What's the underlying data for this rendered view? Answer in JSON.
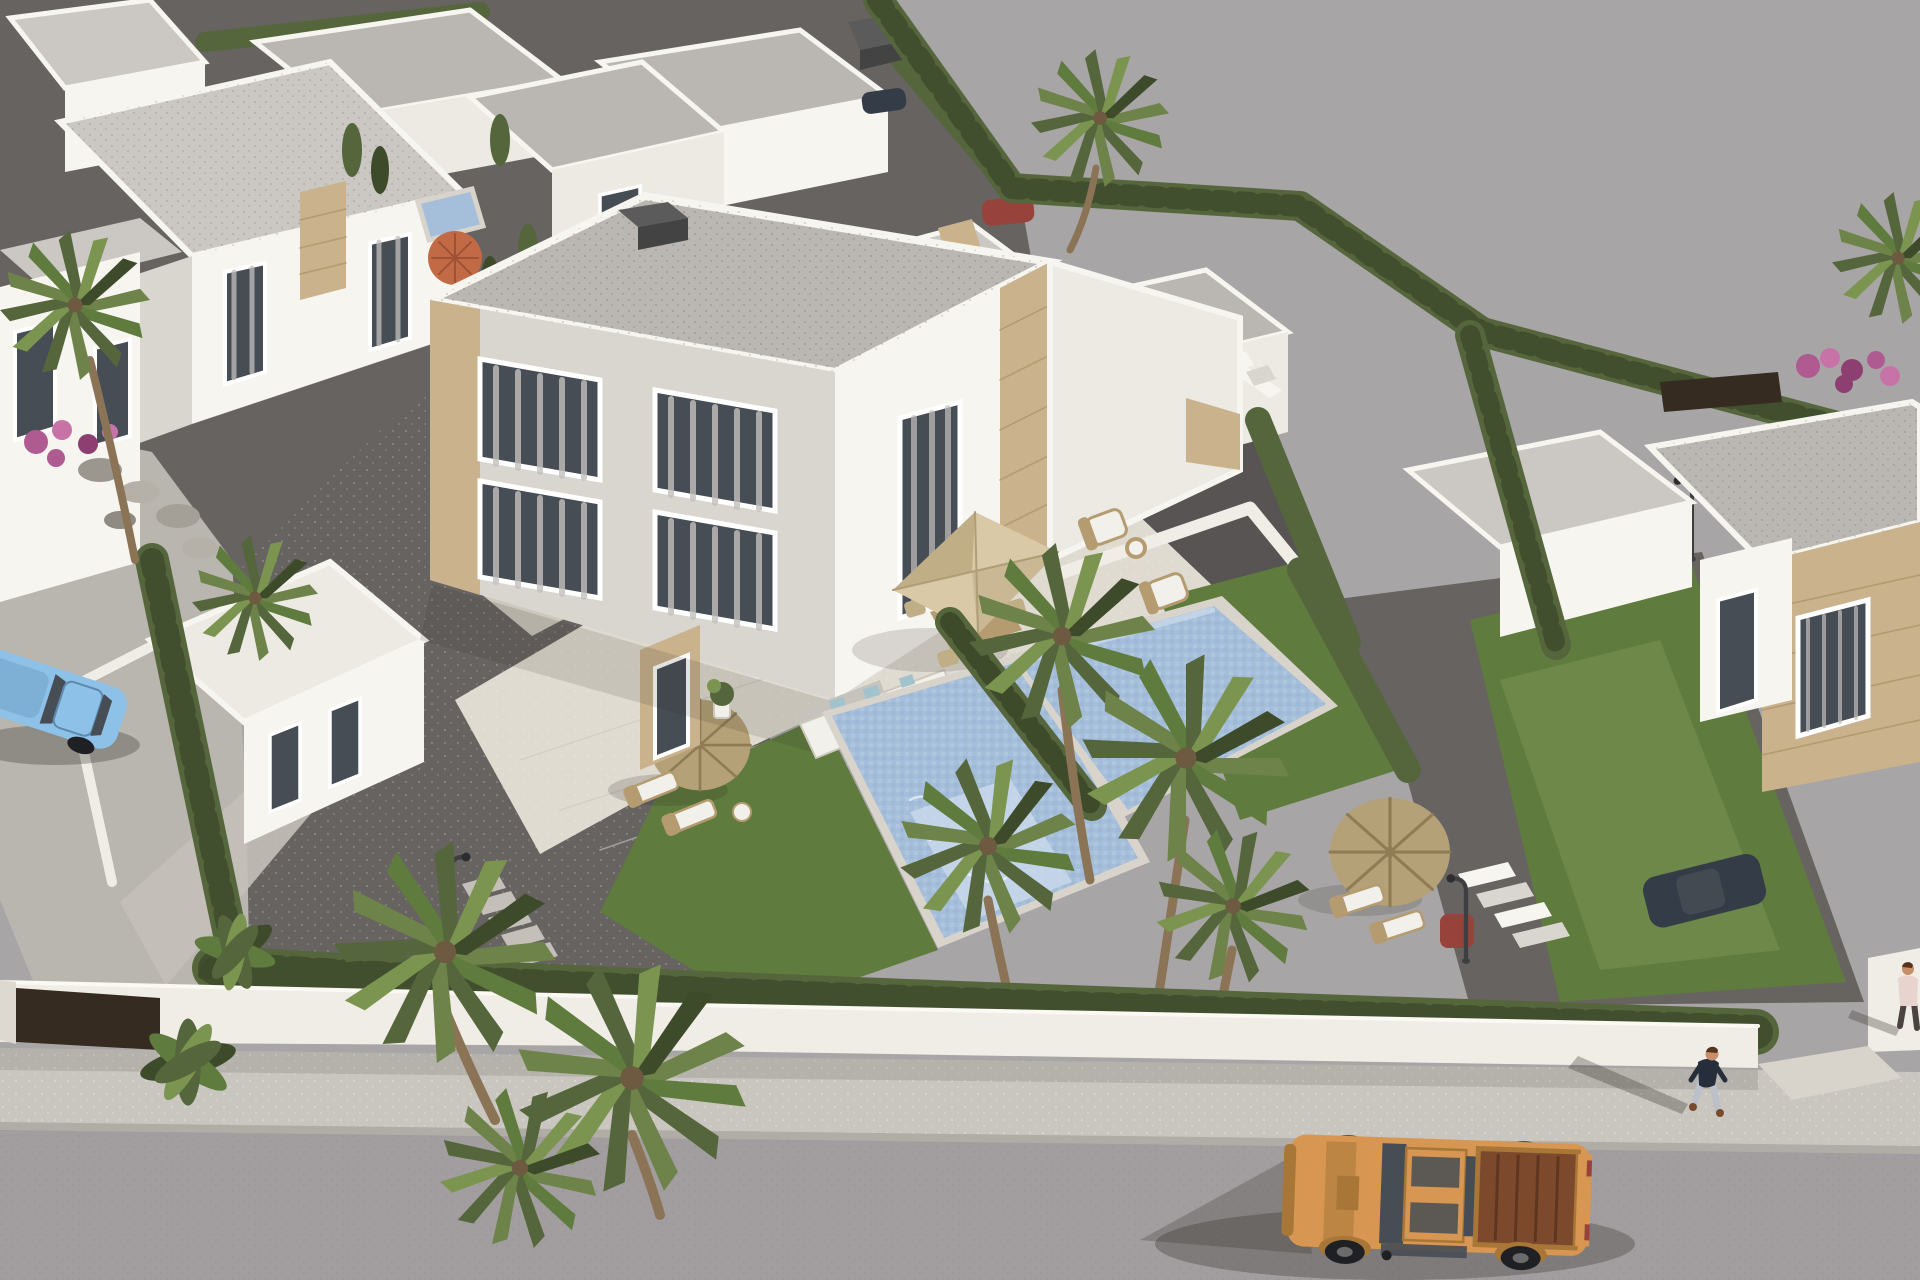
{
  "scene": {
    "label": "Aerial 3D architectural render of a modern white villa development with private pools, gravel gardens, palm trees, a street with a tan pickup truck and pedestrians",
    "objects": [
      "white-villas",
      "duplex-villa",
      "flat-roofs",
      "stone-cladding",
      "curtained-windows",
      "glass-balustrade-terrace",
      "outdoor-corner-sofa",
      "beige-square-parasol",
      "dining-set",
      "wicker-armchairs",
      "sun-loungers",
      "straw-parasols",
      "orange-parasol",
      "left-swimming-pool",
      "right-swimming-pool",
      "lawns",
      "gravel-gardens",
      "cypress-hedges",
      "palm-trees",
      "banana-plants",
      "bougainvillea",
      "rock-bed",
      "perimeter-wall",
      "driveway-gate",
      "stepping-stones",
      "street-lamps",
      "sidewalk",
      "street",
      "pickup-truck",
      "blue-car",
      "red-car",
      "dark-car",
      "walking-pedestrian",
      "partial-pedestrian",
      "empty-ground"
    ]
  },
  "colors": {
    "field": "#a8a5a6",
    "road": "#a29e9f",
    "sidewalk": "#c9c5bf",
    "curb": "#b0aca6",
    "apron": "#d8d4cc",
    "wall": "#f0ede6",
    "wall_shade": "#ddd9d1",
    "gate": "#352b21",
    "hedge_dark": "#3e4b2b",
    "hedge_mid": "#55663c",
    "hedge_light": "#6e8349",
    "lawn": "#5f7b3e",
    "lawn_light": "#7b9551",
    "gravel": "#666361",
    "gravel_dark": "#575453",
    "path": "#c4c0b9",
    "villa": "#f7f5f0",
    "villa_light": "#eceae3",
    "villa_shade": "#d9d6cf",
    "villa_dark": "#c6c3bc",
    "roof": "#bab7b3",
    "roof_light": "#cbc8c4",
    "roof_dark": "#a7a4a0",
    "stone": "#c9b28c",
    "stone_dark": "#ab9568",
    "glass": "#474d55",
    "curtain": "#c3c0bd",
    "pool": "#a5bed9",
    "pool_light": "#c8d8ea",
    "pool_dark": "#8fa9c9",
    "coping": "#d9d4cb",
    "tile": "#e0dbd1",
    "tile_shade": "#cdc7bc",
    "parasol_beige": "#d9c9a7",
    "parasol_beige_dark": "#c0ae87",
    "straw": "#b5a177",
    "straw_dark": "#8f7c55",
    "parasol_orange": "#c16a45",
    "wood": "#b59b70",
    "cushion": "#f2f0ea",
    "pillow_blue": "#a2c2cd",
    "truck": "#d79752",
    "truck_dark": "#a87637",
    "truck_bed": "#7c492c",
    "tire": "#1f2023",
    "car_blue": "#8dc1e7",
    "car_blue_dark": "#5e8aae",
    "car_red": "#97423a",
    "car_navy": "#343c48",
    "skin": "#c78e68",
    "hair": "#54331f",
    "shirt": "#262d3b",
    "jeans": "#bcc1c9",
    "shoe": "#7a4a2c",
    "shirt_pink": "#e8d3cf",
    "trunk": "#8b7356",
    "chimney_dark": "#5b5b5b",
    "chimney_side": "#434343",
    "glass_rail": "#dfe9ee",
    "shadow": "rgba(45,42,38,0.30)"
  }
}
